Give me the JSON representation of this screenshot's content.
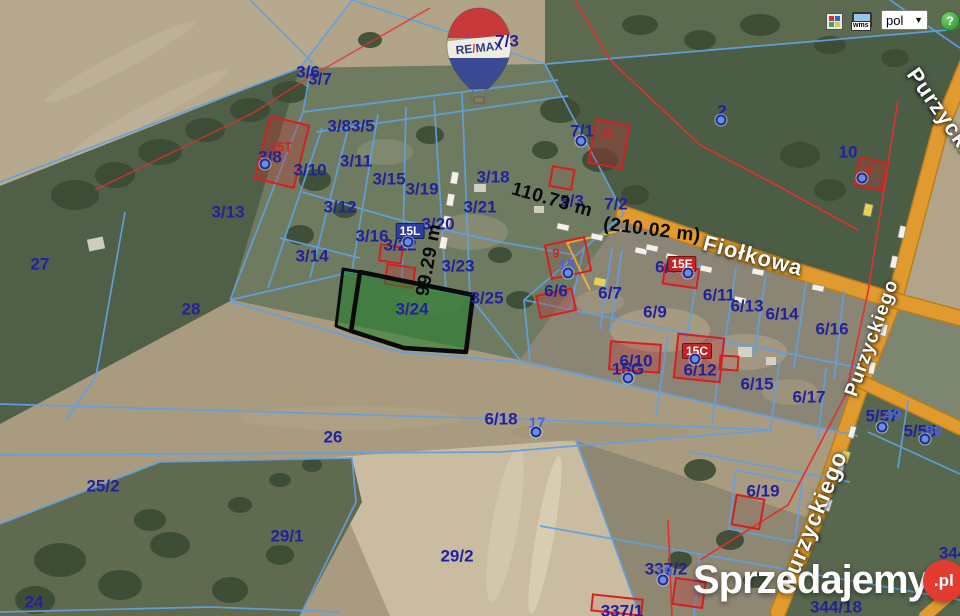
{
  "colors": {
    "navy": "#22229a",
    "address_blue": "#4d63d6",
    "building_red": "#cf2525",
    "boundary_cyan": "#63a0e0",
    "road_orange": "#e09a2e",
    "red_line": "#e03030",
    "highlight_green": "#2e8f3c",
    "help_green": "#3f9e43",
    "watermark_red": "#e23b30"
  },
  "toolbar": {
    "wms_label": "wms",
    "language_value": "pol",
    "caret": "▼",
    "help_label": "?"
  },
  "branding": {
    "balloon_left": "RE",
    "balloon_slash": "/",
    "balloon_right": "MAX",
    "watermark_text": "Sprzedajemy",
    "watermark_suffix": ".pl"
  },
  "map": {
    "highlighted_parcel": "3/24",
    "street_labels": [
      {
        "t": "Fiołkowa",
        "x": 753,
        "y": 256,
        "rot": 15,
        "size": 22
      },
      {
        "t": "Purzyckiego",
        "x": 872,
        "y": 338,
        "rot": -70,
        "size": 19
      },
      {
        "t": "Purzyckiego",
        "x": 813,
        "y": 520,
        "rot": -68,
        "size": 23
      },
      {
        "t": "Purzyckiego",
        "x": 952,
        "y": 128,
        "rot": 55,
        "size": 22
      }
    ],
    "measurements": [
      {
        "t": "110.73 m",
        "x": 552,
        "y": 200,
        "rot": 16
      },
      {
        "t": "(210.02 m)",
        "x": 652,
        "y": 230,
        "rot": 7
      },
      {
        "t": "99.29 m",
        "x": 429,
        "y": 260,
        "rot": -80
      }
    ],
    "parcel_labels": [
      {
        "t": "3/6",
        "x": 308,
        "y": 72
      },
      {
        "t": "3/7",
        "x": 320,
        "y": 79
      },
      {
        "t": "7/3",
        "x": 507,
        "y": 41
      },
      {
        "t": "3/83/5",
        "x": 351,
        "y": 126
      },
      {
        "t": "7/1",
        "x": 582,
        "y": 131
      },
      {
        "t": "2",
        "x": 722,
        "y": 111
      },
      {
        "t": "10",
        "x": 848,
        "y": 152
      },
      {
        "t": "3/8",
        "x": 270,
        "y": 157
      },
      {
        "t": "3/10",
        "x": 310,
        "y": 170
      },
      {
        "t": "3/11",
        "x": 356,
        "y": 161
      },
      {
        "t": "3/15",
        "x": 389,
        "y": 179
      },
      {
        "t": "3/19",
        "x": 422,
        "y": 189
      },
      {
        "t": "3/18",
        "x": 493,
        "y": 177
      },
      {
        "t": "3/13",
        "x": 228,
        "y": 212
      },
      {
        "t": "3/12",
        "x": 340,
        "y": 207
      },
      {
        "t": "3/21",
        "x": 480,
        "y": 207
      },
      {
        "t": "5/3",
        "x": 572,
        "y": 201
      },
      {
        "t": "7/2",
        "x": 616,
        "y": 204
      },
      {
        "t": "3/16",
        "x": 372,
        "y": 236
      },
      {
        "t": "3/20",
        "x": 438,
        "y": 224
      },
      {
        "t": "3/22",
        "x": 400,
        "y": 245
      },
      {
        "t": "3/14",
        "x": 312,
        "y": 256
      },
      {
        "t": "3/23",
        "x": 458,
        "y": 266
      },
      {
        "t": "6/8",
        "x": 667,
        "y": 267
      },
      {
        "t": "27",
        "x": 40,
        "y": 264
      },
      {
        "t": "6/6",
        "x": 556,
        "y": 291
      },
      {
        "t": "6/7",
        "x": 610,
        "y": 293
      },
      {
        "t": "6/11",
        "x": 719,
        "y": 295
      },
      {
        "t": "6/13",
        "x": 747,
        "y": 306
      },
      {
        "t": "6/14",
        "x": 782,
        "y": 314
      },
      {
        "t": "6/16",
        "x": 832,
        "y": 329
      },
      {
        "t": "3/25",
        "x": 487,
        "y": 298
      },
      {
        "t": "28",
        "x": 191,
        "y": 309
      },
      {
        "t": "3/24",
        "x": 412,
        "y": 309
      },
      {
        "t": "6/9",
        "x": 655,
        "y": 312
      },
      {
        "t": "6/10",
        "x": 636,
        "y": 361
      },
      {
        "t": "15G",
        "x": 628,
        "y": 369
      },
      {
        "t": "6/12",
        "x": 700,
        "y": 370
      },
      {
        "t": "6/15",
        "x": 757,
        "y": 384
      },
      {
        "t": "6/17",
        "x": 809,
        "y": 397
      },
      {
        "t": "5/57",
        "x": 882,
        "y": 416
      },
      {
        "t": "5/55",
        "x": 920,
        "y": 431
      },
      {
        "t": "6/18",
        "x": 501,
        "y": 419
      },
      {
        "t": "26",
        "x": 333,
        "y": 437
      },
      {
        "t": "25/2",
        "x": 103,
        "y": 486
      },
      {
        "t": "6/19",
        "x": 763,
        "y": 491
      },
      {
        "t": "29/1",
        "x": 287,
        "y": 536
      },
      {
        "t": "29/2",
        "x": 457,
        "y": 556
      },
      {
        "t": "337/2",
        "x": 666,
        "y": 569
      },
      {
        "t": "24",
        "x": 34,
        "y": 602
      },
      {
        "t": "337/1",
        "x": 622,
        "y": 611
      },
      {
        "t": "344/18",
        "x": 836,
        "y": 607
      },
      {
        "t": "344",
        "x": 953,
        "y": 553
      }
    ],
    "address_labels": [
      {
        "t": "15",
        "x": 567,
        "y": 265
      },
      {
        "t": "17",
        "x": 537,
        "y": 423
      },
      {
        "t": "19",
        "x": 664,
        "y": 572
      },
      {
        "t": "49",
        "x": 893,
        "y": 415
      },
      {
        "t": "50",
        "x": 934,
        "y": 431
      }
    ],
    "building_labels": [
      {
        "t": "15T",
        "x": 281,
        "y": 147
      },
      {
        "t": "9",
        "x": 556,
        "y": 253
      },
      {
        "t": "11",
        "x": 607,
        "y": 133
      },
      {
        "t": "9",
        "x": 868,
        "y": 170
      }
    ],
    "chip_labels": [
      {
        "t": "15L",
        "x": 410,
        "y": 231,
        "bg": "#2e3da0"
      },
      {
        "t": "15E",
        "x": 682,
        "y": 264,
        "bg": "#c22525"
      },
      {
        "t": "15C",
        "x": 697,
        "y": 351,
        "bg": "#c22525"
      }
    ],
    "address_points": [
      [
        265,
        164
      ],
      [
        581,
        141
      ],
      [
        721,
        120
      ],
      [
        408,
        242
      ],
      [
        568,
        273
      ],
      [
        688,
        273
      ],
      [
        628,
        378
      ],
      [
        536,
        432
      ],
      [
        663,
        580
      ],
      [
        882,
        427
      ],
      [
        925,
        439
      ],
      [
        862,
        178
      ],
      [
        695,
        359
      ]
    ]
  }
}
